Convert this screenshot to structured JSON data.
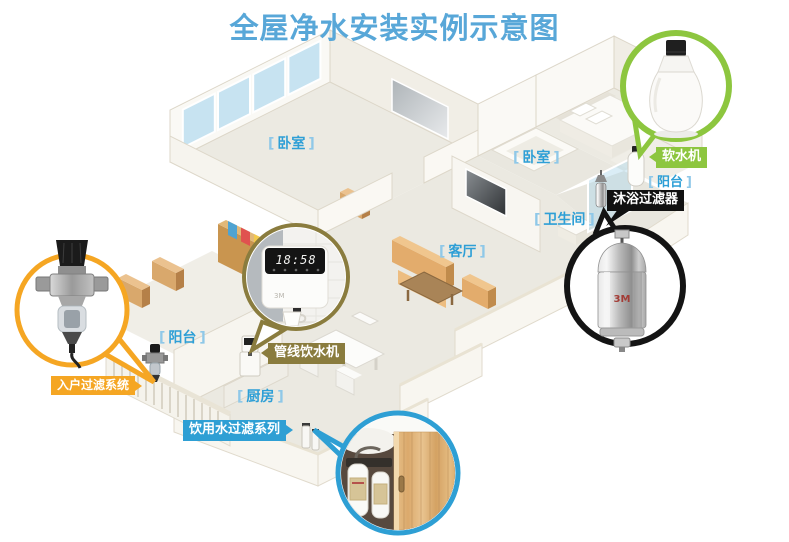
{
  "title": "全屋净水安装实例示意图",
  "brand": "3M",
  "brackets": {
    "left": "[",
    "right": "]"
  },
  "rooms": {
    "bedroom1": {
      "label": "卧室"
    },
    "bedroom2": {
      "label": "卧室"
    },
    "living_room": {
      "label": "客厅"
    },
    "bathroom": {
      "label": "卫生间"
    },
    "balcony_left": {
      "label": "阳台"
    },
    "balcony_right": {
      "label": "阳台"
    },
    "kitchen": {
      "label": "厨房"
    }
  },
  "callouts": {
    "softener": {
      "label": "软水机",
      "color": "#8DC63F"
    },
    "shower_filter": {
      "label": "沐浴过滤器",
      "color": "#111111"
    },
    "entry_filter": {
      "label": "入户过滤系统",
      "color": "#F5A623"
    },
    "pipeline_dispenser": {
      "label": "管线饮水机",
      "color": "#8A7C3E"
    },
    "drinking_filter": {
      "label": "饮用水过滤系列",
      "color": "#2E9FD4"
    }
  },
  "dispenser": {
    "clock": "18:58"
  },
  "colors": {
    "title": "#58A7D8",
    "room_label": "#2E9FD6",
    "green": "#8DC63F",
    "orange": "#F5A623",
    "olive": "#8A7C3E",
    "black": "#111111",
    "blue": "#2E9FD4"
  }
}
